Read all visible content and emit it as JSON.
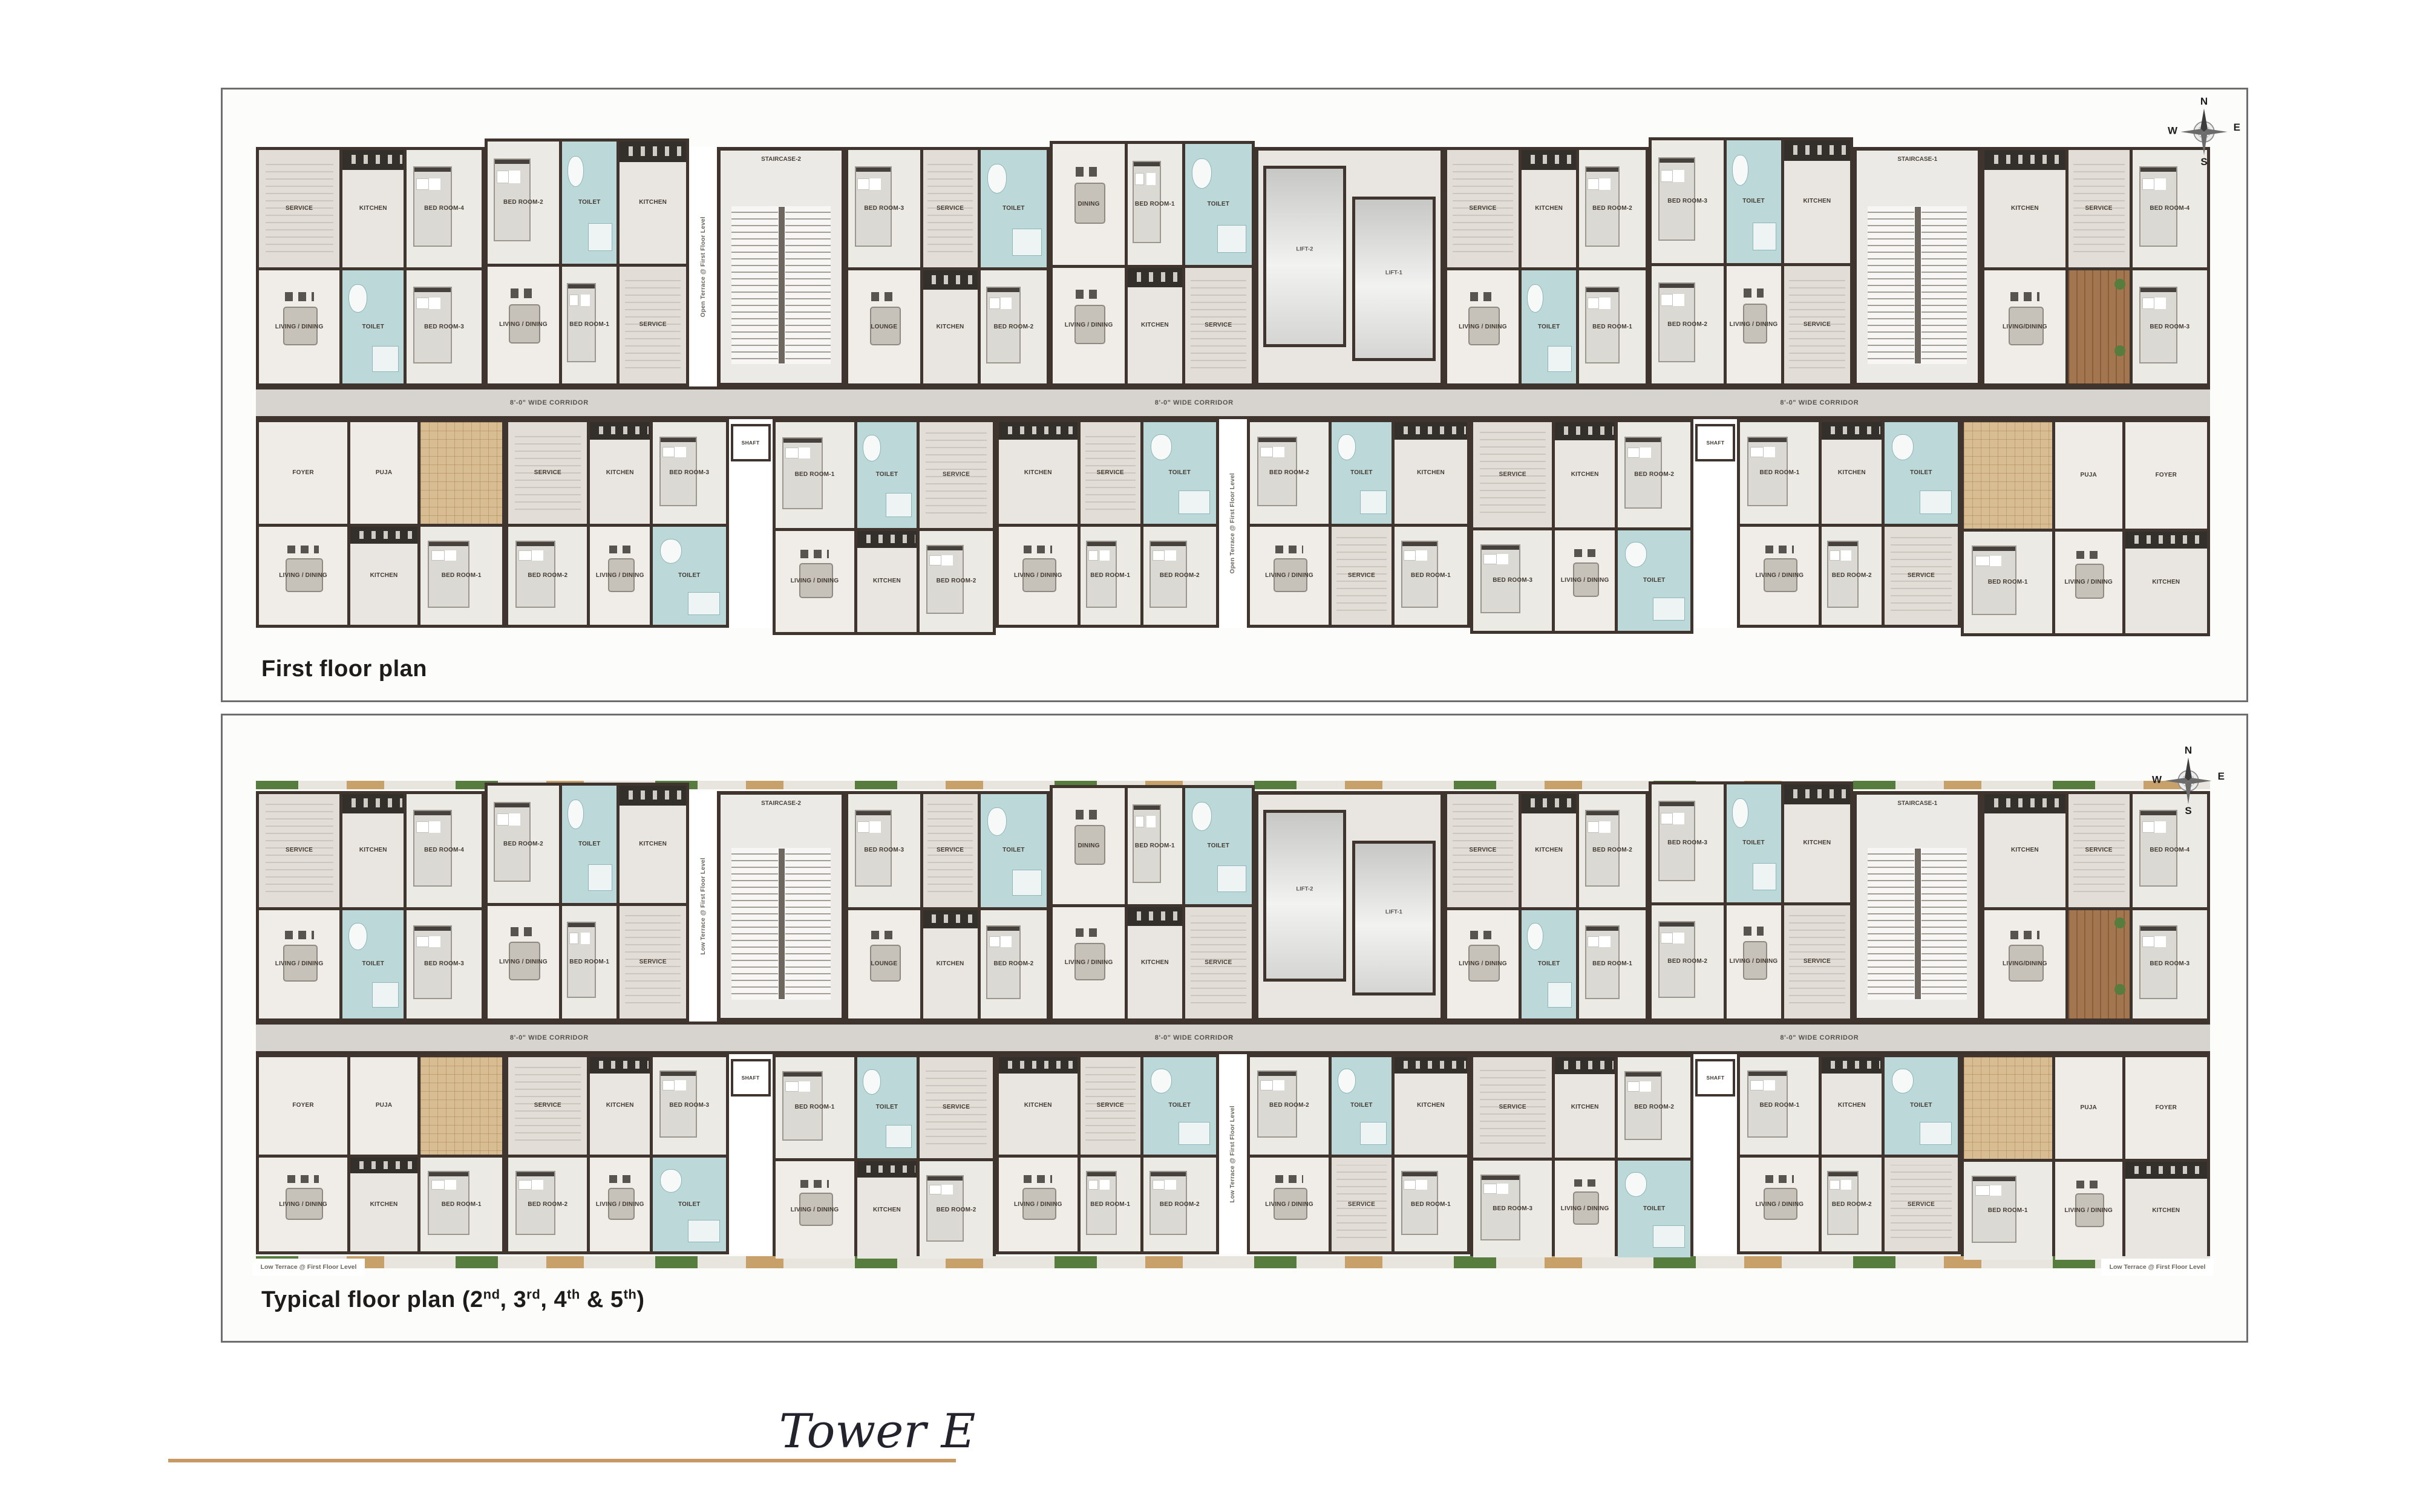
{
  "page": {
    "tower_title": "Tower E"
  },
  "colors": {
    "accent": "#c69a62",
    "wall": "#3f352e",
    "corridor": "#d7d4cf",
    "tile": "#bcd8d9",
    "terrace": "#d9bd92",
    "deck": "#a3764f",
    "plant": "#567d3e",
    "panel-border": "#6e6e6e"
  },
  "compass": {
    "north": "N",
    "east": "E",
    "south": "S",
    "west": "W"
  },
  "panels": [
    {
      "name": "first-floor",
      "caption_parts": [
        {
          "t": "First floor plan"
        }
      ],
      "terrace_note": "Open Terrace @ First Floor Level"
    },
    {
      "name": "typical-floor",
      "caption_parts": [
        {
          "t": "Typical floor plan (2"
        },
        {
          "sup": "nd"
        },
        {
          "t": ", 3"
        },
        {
          "sup": "rd"
        },
        {
          "t": ", 4"
        },
        {
          "sup": "th"
        },
        {
          "t": " & 5"
        },
        {
          "sup": "th"
        },
        {
          "t": ")"
        }
      ],
      "terrace_note": "Low Terrace @ First Floor Level"
    }
  ],
  "floorplan": {
    "corridor_label": "8'-0\" WIDE CORRIDOR",
    "core": {
      "lift1": "LIFT-1",
      "lift2": "LIFT-2",
      "stair1": "STAIRCASE-1",
      "stair2": "STAIRCASE-2",
      "shaft": "SHAFT"
    },
    "top_units": [
      [
        {
          "l": "SERVICE",
          "t": "service"
        },
        {
          "l": "KITCHEN",
          "t": "kitchen"
        },
        {
          "l": "BED ROOM-4",
          "t": "bed"
        },
        {
          "l": "LIVING / DINING",
          "t": "living"
        },
        {
          "l": "TOILET",
          "t": "toilet"
        },
        {
          "l": "BED ROOM-3",
          "t": "bed"
        }
      ],
      [
        {
          "l": "BED ROOM-2",
          "t": "bed"
        },
        {
          "l": "TOILET",
          "t": "toilet"
        },
        {
          "l": "KITCHEN",
          "t": "kitchen"
        },
        {
          "l": "LIVING / DINING",
          "t": "living"
        },
        {
          "l": "BED ROOM-1",
          "t": "bed"
        },
        {
          "l": "SERVICE",
          "t": "service"
        }
      ],
      [
        {
          "l": "BED ROOM-3",
          "t": "bed"
        },
        {
          "l": "SERVICE",
          "t": "service"
        },
        {
          "l": "TOILET",
          "t": "toilet"
        },
        {
          "l": "LOUNGE",
          "t": "living"
        },
        {
          "l": "KITCHEN",
          "t": "kitchen"
        },
        {
          "l": "BED ROOM-2",
          "t": "bed"
        }
      ],
      [
        {
          "l": "DINING",
          "t": "living"
        },
        {
          "l": "BED ROOM-1",
          "t": "bed"
        },
        {
          "l": "TOILET",
          "t": "toilet"
        },
        {
          "l": "LIVING / DINING",
          "t": "living"
        },
        {
          "l": "KITCHEN",
          "t": "kitchen"
        },
        {
          "l": "SERVICE",
          "t": "service"
        }
      ],
      [
        {
          "l": "SERVICE",
          "t": "service"
        },
        {
          "l": "KITCHEN",
          "t": "kitchen"
        },
        {
          "l": "BED ROOM-2",
          "t": "bed"
        },
        {
          "l": "LIVING / DINING",
          "t": "living"
        },
        {
          "l": "TOILET",
          "t": "toilet"
        },
        {
          "l": "BED ROOM-1",
          "t": "bed"
        }
      ],
      [
        {
          "l": "BED ROOM-3",
          "t": "bed"
        },
        {
          "l": "TOILET",
          "t": "toilet"
        },
        {
          "l": "KITCHEN",
          "t": "kitchen"
        },
        {
          "l": "BED ROOM-2",
          "t": "bed"
        },
        {
          "l": "LIVING / DINING",
          "t": "living"
        },
        {
          "l": "SERVICE",
          "t": "service"
        }
      ],
      [
        {
          "l": "KITCHEN",
          "t": "kitchen"
        },
        {
          "l": "SERVICE",
          "t": "service"
        },
        {
          "l": "BED ROOM-4",
          "t": "bed"
        },
        {
          "l": "LIVING/DINING",
          "t": "living"
        },
        {
          "l": "",
          "t": "deck"
        },
        {
          "l": "BED ROOM-3",
          "t": "bed"
        }
      ]
    ],
    "bottom_units": [
      [
        {
          "l": "FOYER",
          "t": "plain"
        },
        {
          "l": "PUJA",
          "t": "plain"
        },
        {
          "l": "",
          "t": "terrace"
        },
        {
          "l": "LIVING / DINING",
          "t": "living"
        },
        {
          "l": "KITCHEN",
          "t": "kitchen"
        },
        {
          "l": "BED ROOM-1",
          "t": "bed"
        }
      ],
      [
        {
          "l": "SERVICE",
          "t": "service"
        },
        {
          "l": "KITCHEN",
          "t": "kitchen"
        },
        {
          "l": "BED ROOM-3",
          "t": "bed"
        },
        {
          "l": "BED ROOM-2",
          "t": "bed"
        },
        {
          "l": "LIVING / DINING",
          "t": "living"
        },
        {
          "l": "TOILET",
          "t": "toilet"
        }
      ],
      [
        {
          "l": "BED ROOM-1",
          "t": "bed"
        },
        {
          "l": "TOILET",
          "t": "toilet"
        },
        {
          "l": "SERVICE",
          "t": "service"
        },
        {
          "l": "LIVING / DINING",
          "t": "living"
        },
        {
          "l": "KITCHEN",
          "t": "kitchen"
        },
        {
          "l": "BED ROOM-2",
          "t": "bed"
        }
      ],
      [
        {
          "l": "KITCHEN",
          "t": "kitchen"
        },
        {
          "l": "SERVICE",
          "t": "service"
        },
        {
          "l": "TOILET",
          "t": "toilet"
        },
        {
          "l": "LIVING / DINING",
          "t": "living"
        },
        {
          "l": "BED ROOM-1",
          "t": "bed"
        },
        {
          "l": "BED ROOM-2",
          "t": "bed"
        }
      ],
      [
        {
          "l": "BED ROOM-2",
          "t": "bed"
        },
        {
          "l": "TOILET",
          "t": "toilet"
        },
        {
          "l": "KITCHEN",
          "t": "kitchen"
        },
        {
          "l": "LIVING / DINING",
          "t": "living"
        },
        {
          "l": "SERVICE",
          "t": "service"
        },
        {
          "l": "BED ROOM-1",
          "t": "bed"
        }
      ],
      [
        {
          "l": "SERVICE",
          "t": "service"
        },
        {
          "l": "KITCHEN",
          "t": "kitchen"
        },
        {
          "l": "BED ROOM-2",
          "t": "bed"
        },
        {
          "l": "BED ROOM-3",
          "t": "bed"
        },
        {
          "l": "LIVING / DINING",
          "t": "living"
        },
        {
          "l": "TOILET",
          "t": "toilet"
        }
      ],
      [
        {
          "l": "BED ROOM-1",
          "t": "bed"
        },
        {
          "l": "KITCHEN",
          "t": "kitchen"
        },
        {
          "l": "TOILET",
          "t": "toilet"
        },
        {
          "l": "LIVING / DINING",
          "t": "living"
        },
        {
          "l": "BED ROOM-2",
          "t": "bed"
        },
        {
          "l": "SERVICE",
          "t": "service"
        }
      ],
      [
        {
          "l": "",
          "t": "terrace"
        },
        {
          "l": "PUJA",
          "t": "plain"
        },
        {
          "l": "FOYER",
          "t": "plain"
        },
        {
          "l": "BED ROOM-1",
          "t": "bed"
        },
        {
          "l": "LIVING / DINING",
          "t": "living"
        },
        {
          "l": "KITCHEN",
          "t": "kitchen"
        }
      ]
    ]
  }
}
